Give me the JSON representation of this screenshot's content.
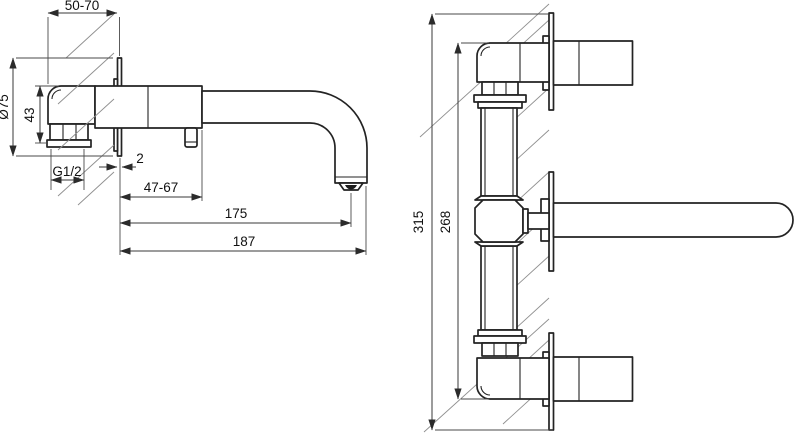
{
  "drawing": {
    "side_view": {
      "dimensions": {
        "depth_adjust_range": "50-70",
        "escutcheon_diameter": "Ø75",
        "inlet_elbow_height": "43",
        "thread_size": "G1/2",
        "escutcheon_thickness": "2",
        "body_depth_range": "47-67",
        "spout_reach": "175",
        "overall_depth": "187"
      }
    },
    "front_view": {
      "dimensions": {
        "overall_height": "315",
        "pipe_assembly_height": "268"
      }
    }
  },
  "colors": {
    "background": "#ffffff",
    "outline": "#232323",
    "dimension": "#3a3a3a",
    "hatching": "#8f8f8f",
    "text": "#111111"
  }
}
